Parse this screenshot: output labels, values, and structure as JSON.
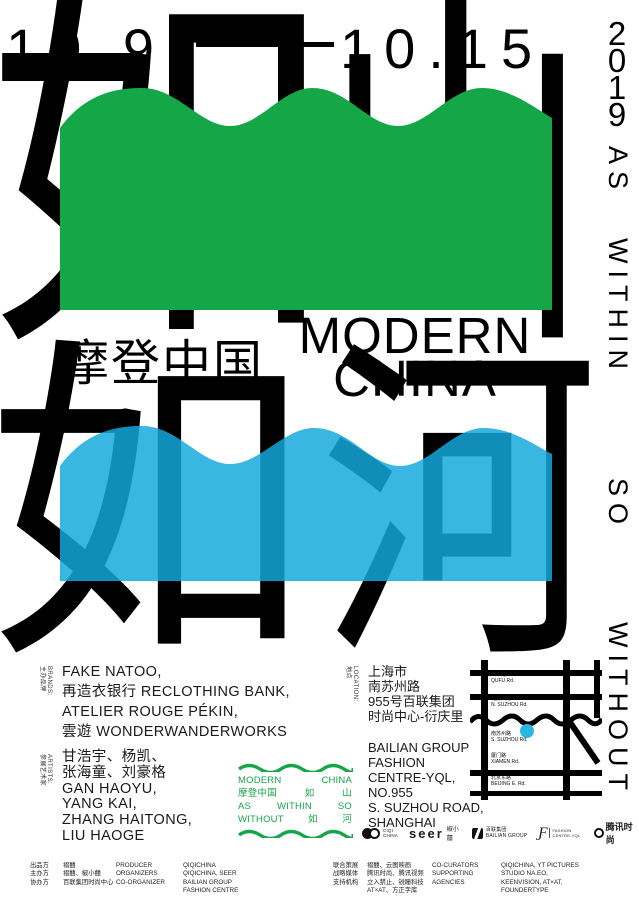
{
  "colors": {
    "green": "#15A648",
    "blue": "rgba(19,169,221,0.84)",
    "ink": "#000000",
    "marker": "#29B6E2"
  },
  "dates": {
    "start": "10.9",
    "end": "10.15",
    "year_digits": [
      "2",
      "0",
      "1",
      "9"
    ]
  },
  "hero": {
    "top_char_1": "如",
    "top_char_2": "山",
    "bottom_char_1": "如",
    "bottom_char_2": "河",
    "subtitle_cn": "摩登中国",
    "title_en_line1": "MODERN",
    "title_en_line2": "CHINA"
  },
  "side_text": {
    "words": [
      "AS",
      "WITHIN",
      "SO",
      "WITHOUT"
    ]
  },
  "brands": {
    "label_cn": "主办品牌",
    "label_en": "BRANDS:",
    "lines": [
      "FAKE NATOO,",
      "再造衣银行 RECLOTHING BANK,",
      "ATELIER ROUGE PÉKIN,",
      "雲遊 WONDERWANDERWORKS"
    ]
  },
  "artists": {
    "label_cn": "参展艺术家",
    "label_en": "ARTISTS:",
    "lines": [
      "甘浩宇、杨凯、",
      "张海童、刘豪格",
      "GAN HAOYU,",
      "YANG KAI,",
      "ZHANG HAITONG,",
      "LIU HAOGE"
    ]
  },
  "location": {
    "label_cn": "地点",
    "label_en": "LOCATION:",
    "cn_lines": [
      "上海市",
      "南苏州路",
      "955号百联集团",
      "时尚中心-衍庆里"
    ],
    "en_lines": [
      "BAILIAN GROUP",
      "FASHION",
      "CENTRE-YQL,",
      "NO.955",
      "S. SUZHOU ROAD,",
      "SHANGHAI"
    ]
  },
  "stamp": {
    "lines": [
      [
        "MODERN",
        "CHINA"
      ],
      [
        "摩登中国",
        "如",
        "山"
      ],
      [
        "AS",
        "WITHIN",
        "SO"
      ],
      [
        "WITHOUT",
        "如",
        "河"
      ]
    ]
  },
  "map": {
    "streets": [
      {
        "cn": "曲阜路",
        "en": "QUFU Rd."
      },
      {
        "cn": "北苏州路",
        "en": "N. SUZHOU Rd."
      },
      {
        "cn": "南苏州路",
        "en": "S. SUZHOU Rd."
      },
      {
        "cn": "厦门路",
        "en": "XIAMEN Rd."
      },
      {
        "cn": "北京东路",
        "en": "BEIJING E. Rd."
      }
    ]
  },
  "partners": [
    {
      "line1": "CIQI",
      "line2": "CHINA"
    },
    {
      "name": "seer",
      "cn": "椒小囍"
    },
    {
      "cn": "百联集团",
      "en": "BAILIAN GROUP"
    },
    {
      "mark": "Ƒ",
      "line1": "FASHION",
      "line2": "CENTRE-YQL"
    },
    {
      "name": "腾讯时尚"
    }
  ],
  "credits": {
    "left": {
      "labels": [
        "出品方",
        "主办方",
        "协办方"
      ],
      "values_cn": [
        "褶囍",
        "褶囍、椒小囍",
        "百联集团时尚中心"
      ],
      "labels_en": [
        "PRODUCER",
        "ORGANIZERS",
        "CO-ORGANIZER"
      ],
      "values_en": [
        "QIQICHINA",
        "QIQICHINA, SEER",
        "BAILIAN GROUP",
        "FASHION CENTRE"
      ]
    },
    "right": {
      "labels": [
        "联合策展",
        "战略媒体",
        "支持机构"
      ],
      "values_cn": [
        "褶囍、云图映画",
        "腾讯时尚、腾讯视频",
        "立入禁止、锐瞳科技",
        "AT×AT、方正字库"
      ],
      "labels_en": [
        "CO-CURATORS",
        "SUPPORTING",
        "AGENCIES"
      ],
      "values_en": [
        "QIQICHINA, YT PICTURES",
        "STUDIO NA.EO,",
        "KEENVISION, AT×AT,",
        "FOUNDERTYPE"
      ]
    }
  }
}
